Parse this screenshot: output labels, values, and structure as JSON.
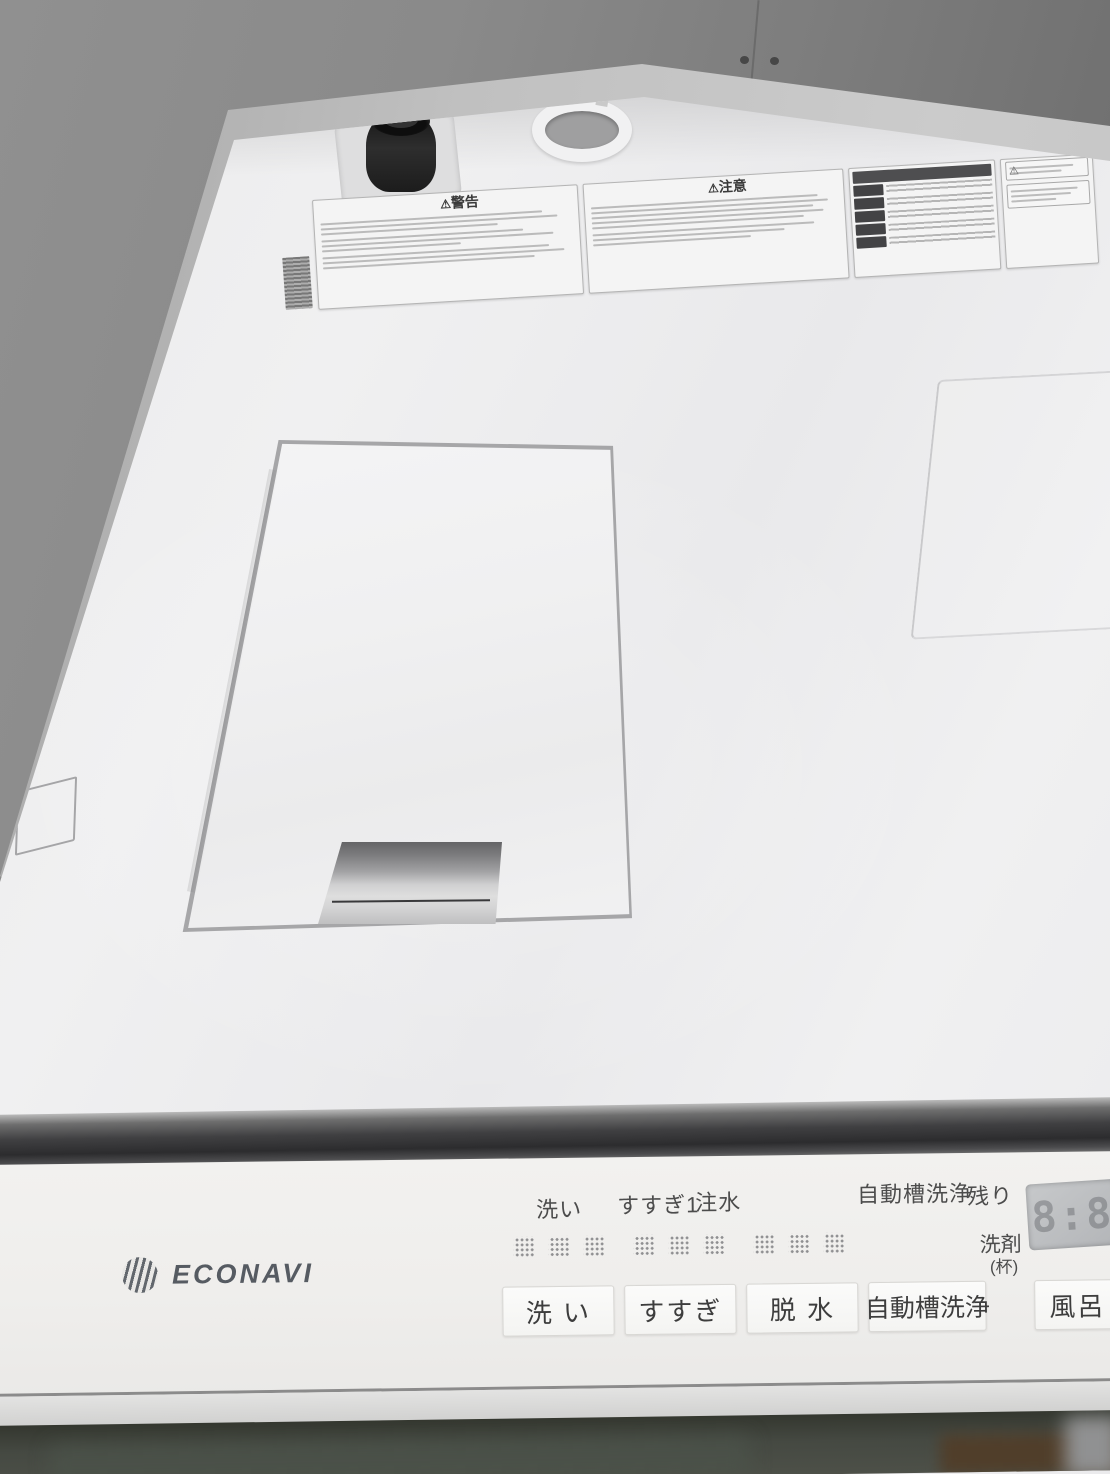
{
  "scene": {
    "subject": "Top-load washing machine viewed from above: white top deck with warning labels, filter access lid, and ECONAVI control panel"
  },
  "warning_label": {
    "warning_icon": "⚠",
    "warning_title": "警告",
    "caution_icon": "⚠",
    "caution_title": "注意"
  },
  "panel": {
    "brand": "ECONAVI",
    "status_labels": [
      {
        "label": "洗い"
      },
      {
        "label": "すすぎ1"
      },
      {
        "label": "注水"
      },
      {
        "label": "自動槽洗浄"
      },
      {
        "label": "残り"
      }
    ],
    "detergent_label": "洗剤",
    "detergent_unit": "(杯)",
    "display_value": "8:8",
    "buttons": [
      {
        "label": "洗 い"
      },
      {
        "label": "すすぎ"
      },
      {
        "label": "脱 水"
      },
      {
        "label": "自動槽洗浄"
      },
      {
        "label": "風呂"
      }
    ]
  },
  "colors": {
    "deck_white": "#efeff0",
    "wall_gray": "#8a8a8a",
    "wall_dark": "#686868",
    "gap_band_dark": "#2c2c2e",
    "panel_white": "#f0efed",
    "display_bg": "#bfc1c4",
    "button_text": "#3d3d3d",
    "front_dark": "#454942"
  }
}
